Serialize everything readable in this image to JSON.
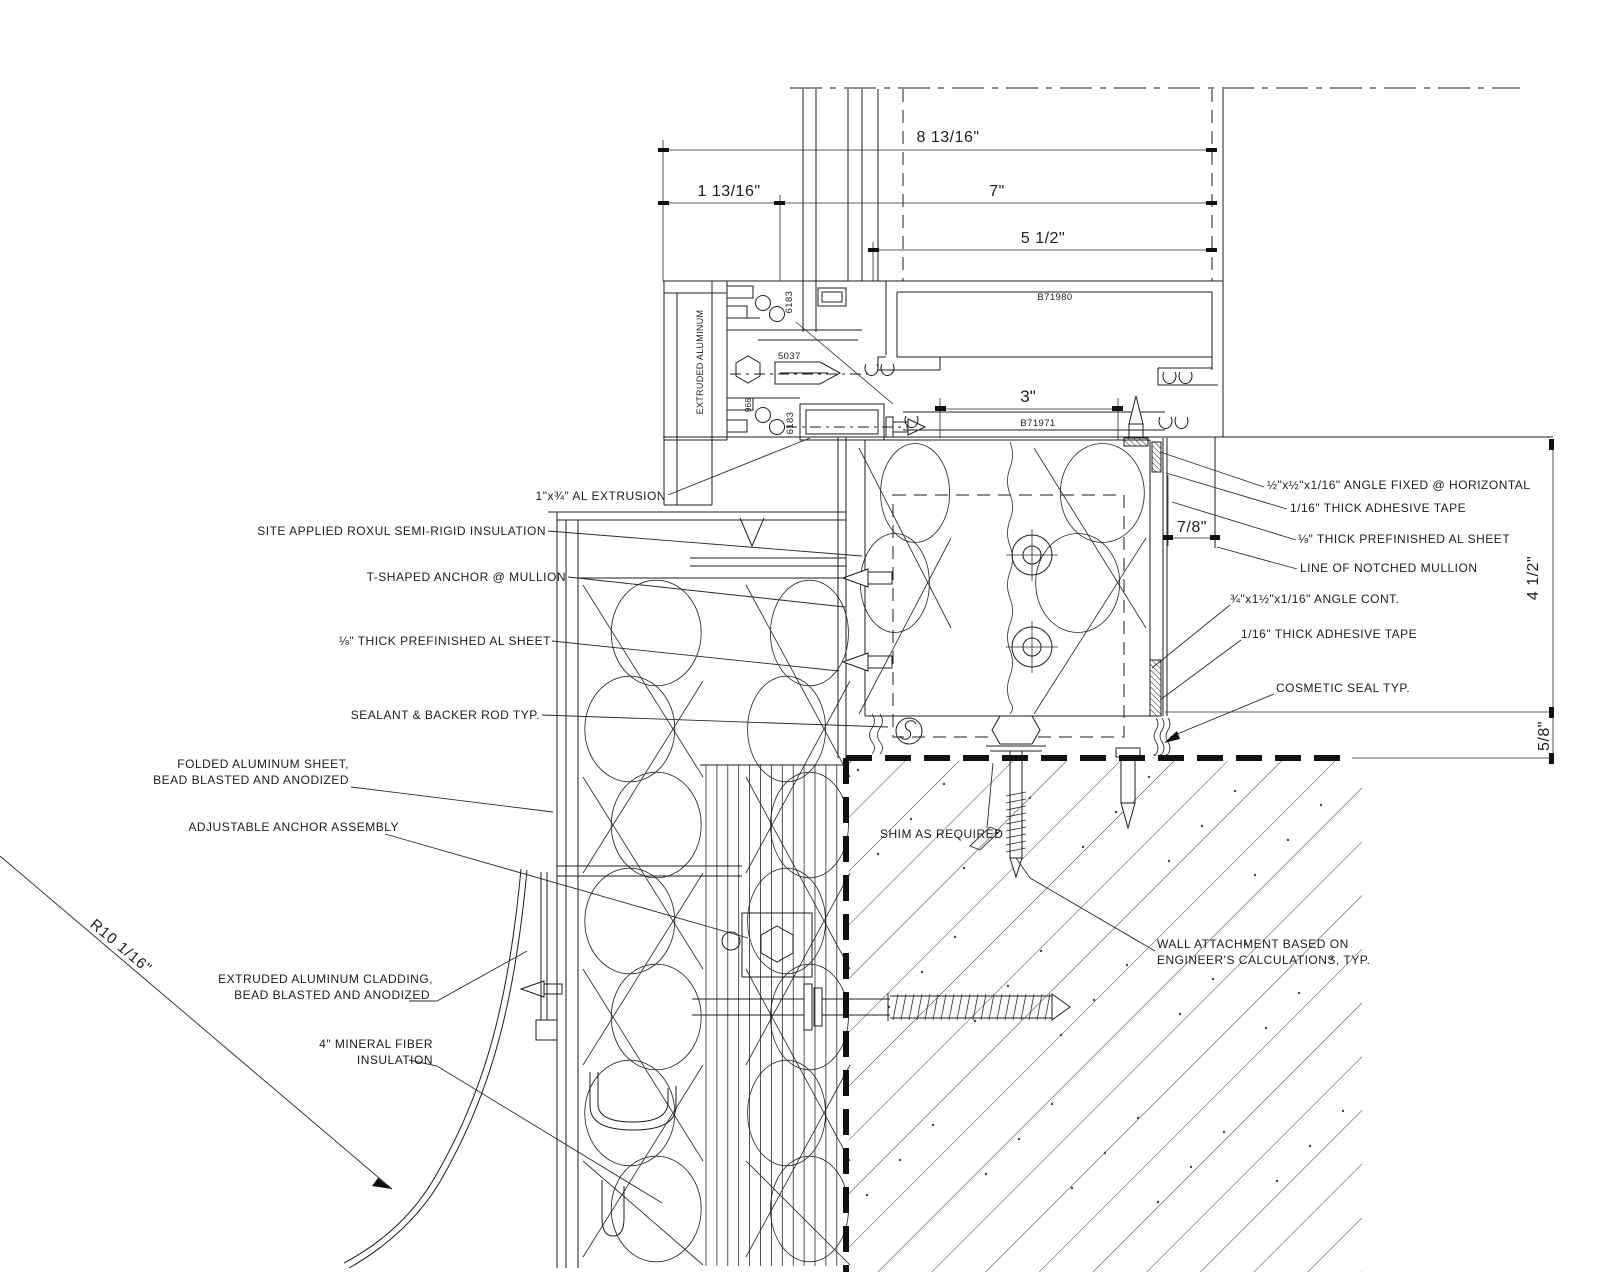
{
  "dwg": {
    "title_hint": "window jamb / mullion plan detail",
    "dims": {
      "d1": "8 13/16\"",
      "d2": "1 13/16\"",
      "d3": "7\"",
      "d4": "5 1/2\"",
      "d5": "3\"",
      "d6": "7/8\"",
      "d7": "4 1/2\"",
      "d8": "5/8\"",
      "radius": "R10 1/16\""
    },
    "parts": {
      "b71980": "B71980",
      "b71971": "B71971",
      "p6183a": "6183",
      "p6183b": "6183",
      "p5037": "5037",
      "p966": "966",
      "extruded": "EXTRUDED ALUMINUM"
    },
    "labels_left": {
      "al_extrusion": "1\"x¾\" AL EXTRUSION",
      "roxul": "SITE APPLIED ROXUL SEMI-RIGID INSULATION",
      "t_anchor": "T-SHAPED ANCHOR @ MULLION",
      "sheet_left": "⅛\" THICK PREFINISHED AL SHEET",
      "sealant": "SEALANT & BACKER ROD TYP.",
      "folded1": "FOLDED ALUMINUM SHEET,",
      "folded2": "BEAD BLASTED AND ANODIZED",
      "adjustable": "ADJUSTABLE ANCHOR ASSEMBLY",
      "cladding1": "EXTRUDED ALUMINUM CLADDING,",
      "cladding2": "BEAD BLASTED AND ANODIZED",
      "mineral1": "4\" MINERAL FIBER",
      "mineral2": "INSULATION"
    },
    "labels_right": {
      "angle_fixed": "½\"x½\"x1/16\" ANGLE FIXED @ HORIZONTAL",
      "tape_top": "1/16\" THICK ADHESIVE TAPE",
      "sheet_right": "⅛\" THICK PREFINISHED AL SHEET",
      "notched": "LINE OF NOTCHED MULLION",
      "angle_cont": "¾\"x1½\"x1/16\" ANGLE CONT.",
      "tape_bottom": "1/16\" THICK ADHESIVE TAPE",
      "cosmetic": "COSMETIC SEAL TYP.",
      "shim": "SHIM AS REQUIRED",
      "wall1": "WALL ATTACHMENT BASED ON",
      "wall2": "ENGINEER'S CALCULATIONS, TYP."
    }
  }
}
